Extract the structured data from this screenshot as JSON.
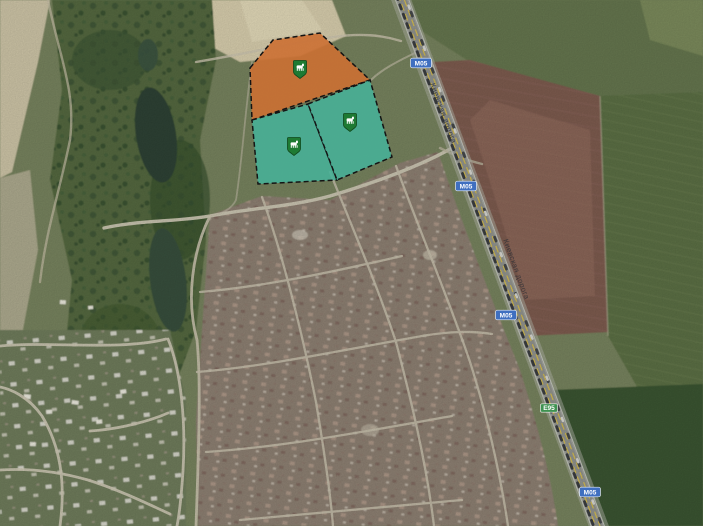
{
  "map": {
    "route_shields": [
      {
        "id": "shield-top",
        "text": "M05",
        "color": "#3f6fc0"
      },
      {
        "id": "shield-upper-mid",
        "text": "M05",
        "color": "#3f6fc0"
      },
      {
        "id": "shield-mid",
        "text": "M05",
        "color": "#3f6fc0"
      },
      {
        "id": "shield-e95",
        "text": "E95",
        "color": "#3f9251"
      },
      {
        "id": "shield-bottom",
        "text": "M05",
        "color": "#3f6fc0"
      }
    ],
    "road_name_labels": [
      {
        "text": "Киевская дорога"
      },
      {
        "text": "Киевская дорога"
      }
    ],
    "parcels": [
      {
        "id": "parcel-north",
        "color": "#cc7033",
        "icon": "farm-pin-icon"
      },
      {
        "id": "parcel-southwest",
        "color": "#47b299",
        "icon": "farm-pin-icon"
      },
      {
        "id": "parcel-southeast",
        "color": "#47b299",
        "icon": "farm-pin-icon"
      }
    ],
    "colors": {
      "parcel_orange": "#cc7033",
      "parcel_teal": "#47b299",
      "parcel_border": "#141414",
      "pin_green": "#1e7a33",
      "pin_border": "#10491d",
      "shield_blue": "#3f6fc0",
      "shield_green": "#3f9251"
    }
  }
}
